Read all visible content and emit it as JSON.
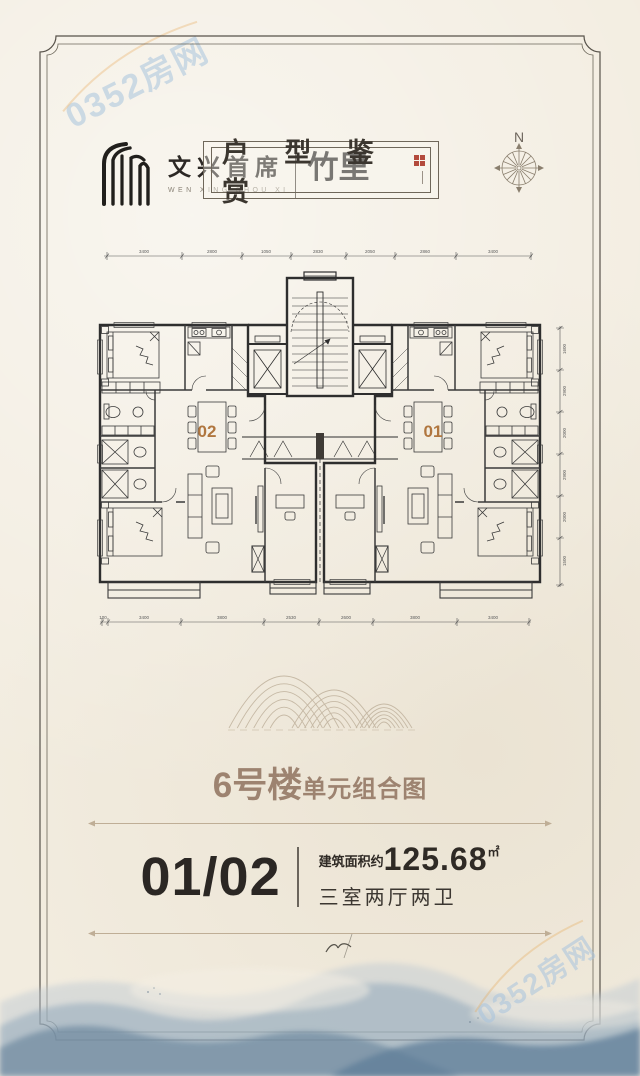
{
  "colors": {
    "paper": "#f2ecdf",
    "plan_line": "#3a3a3a",
    "unit_label": "#b0763f",
    "section_title": "#9d8370",
    "ink_dark": "#2b2724",
    "divider": "#bfae96",
    "watermark": "#a8c4de",
    "seal_red": "#b34a3c"
  },
  "watermark": {
    "text": "0352房网"
  },
  "brand": {
    "name_cn": "文兴首席",
    "name_en": "WEN XING SHOU XI",
    "sub_brand": "竹里"
  },
  "compass": {
    "label": "N"
  },
  "title_banner": {
    "text": "户 型 鉴 赏"
  },
  "floor_plan": {
    "unit_left_label": "02",
    "unit_right_label": "01",
    "dims_top": [
      "3400",
      "2800",
      "1050",
      "2830",
      "2050",
      "2860",
      "3400"
    ],
    "dims_bottom": [
      "100",
      "3400",
      "3800",
      "2530",
      "2600",
      "3800",
      "3400"
    ],
    "dims_right": [
      "1600",
      "2900",
      "2000",
      "2900",
      "2000",
      "1500"
    ]
  },
  "section": {
    "building": "6号楼",
    "suffix": "单元组合图"
  },
  "unit_info": {
    "units": "01/02",
    "area_prefix": "建筑面积约",
    "area_value": "125.68",
    "area_unit": "㎡",
    "layout": "三室两厅两卫"
  }
}
